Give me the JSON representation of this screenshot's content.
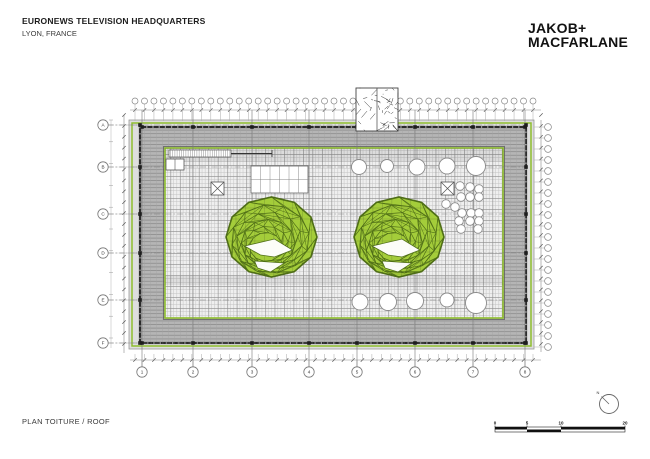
{
  "header": {
    "project_title": "EURONEWS TELEVISION HEADQUARTERS",
    "project_location": "LYON, FRANCE",
    "firm_line1": "JAKOB+",
    "firm_line2": "MACFARLANE"
  },
  "footer": {
    "drawing_title": "PLAN TOITURE / ROOF"
  },
  "scale_bar": {
    "labels": [
      "0",
      "5",
      "10",
      "20"
    ]
  },
  "north_arrow": {
    "label": "N"
  },
  "colors": {
    "crater_green": "#a4cd3a",
    "crater_line": "#4f6e17",
    "edge_green": "#8fbe2e",
    "band_gray": "#b5b5b5",
    "band_stripe": "#8c8c8c",
    "frame_dark": "#2b2b2b"
  },
  "plan": {
    "column_labels": [
      "1",
      "2",
      "3",
      "4",
      "5",
      "6",
      "7",
      "8"
    ],
    "row_labels": [
      "A",
      "B",
      "C",
      "D",
      "E",
      "F"
    ],
    "column_x": [
      142,
      193,
      252,
      309,
      357,
      415,
      473,
      525
    ],
    "row_y": [
      125,
      167,
      214,
      253,
      300,
      343
    ],
    "outer_rect": {
      "x": 129,
      "y": 120,
      "w": 405,
      "h": 229
    },
    "green_edge_rect": {
      "x": 132,
      "y": 123,
      "w": 399,
      "h": 223
    },
    "frame_rect": {
      "x": 140,
      "y": 127,
      "w": 386,
      "h": 216
    },
    "inner_rect": {
      "x": 165,
      "y": 148,
      "w": 338,
      "h": 170
    },
    "facade_bubbles_top": {
      "count": 43,
      "x0": 135,
      "x1": 533,
      "y": 101,
      "r": 3
    },
    "facade_bubbles_right": {
      "count": 21,
      "x": 548,
      "y0": 127,
      "step": 11,
      "r": 3.4
    },
    "left_bubbles": {
      "x": 103,
      "r": 5.2
    },
    "bottom_bubbles": {
      "y": 372,
      "r": 5.2
    },
    "dim_lines": {
      "top_y": 110,
      "bottom_y": 360,
      "left_x": 124,
      "left_x2": 111,
      "right_x": 541
    },
    "craters": [
      {
        "cx": 271.5,
        "cy": 237,
        "rx": 45.5,
        "ry": 40
      },
      {
        "cx": 399,
        "cy": 237,
        "rx": 45,
        "ry": 40
      }
    ],
    "skylights_top": [
      {
        "x": 359,
        "y": 167,
        "r": 7.5
      },
      {
        "x": 387,
        "y": 166,
        "r": 6.5
      },
      {
        "x": 417,
        "y": 167,
        "r": 8
      },
      {
        "x": 447,
        "y": 166,
        "r": 8
      },
      {
        "x": 476,
        "y": 166,
        "r": 9.5
      }
    ],
    "skylights_bottom": [
      {
        "x": 360,
        "y": 302,
        "r": 8
      },
      {
        "x": 388,
        "y": 302,
        "r": 8.5
      },
      {
        "x": 415,
        "y": 301,
        "r": 8.5
      },
      {
        "x": 447,
        "y": 300,
        "r": 7
      },
      {
        "x": 476,
        "y": 303,
        "r": 10.5
      }
    ],
    "vent_cluster": [
      {
        "x": 460,
        "y": 186
      },
      {
        "x": 470,
        "y": 187
      },
      {
        "x": 479,
        "y": 189
      },
      {
        "x": 461,
        "y": 197
      },
      {
        "x": 470,
        "y": 197
      },
      {
        "x": 479,
        "y": 197
      },
      {
        "x": 446,
        "y": 204
      },
      {
        "x": 455,
        "y": 207
      },
      {
        "x": 462,
        "y": 213
      },
      {
        "x": 471,
        "y": 213
      },
      {
        "x": 479,
        "y": 213
      },
      {
        "x": 459,
        "y": 221
      },
      {
        "x": 470,
        "y": 221
      },
      {
        "x": 479,
        "y": 221
      },
      {
        "x": 461,
        "y": 229
      },
      {
        "x": 478,
        "y": 229
      }
    ],
    "vent_radius": 4.3,
    "hatch_squares": [
      {
        "x": 211,
        "y": 182,
        "s": 13
      },
      {
        "x": 441,
        "y": 182,
        "s": 13
      }
    ],
    "skylight_grid": {
      "x": 251,
      "y": 166,
      "w": 57,
      "h": 27,
      "cols": 6,
      "rows": 2
    },
    "hatch_strip": {
      "x": 169,
      "y": 150,
      "w": 62,
      "h": 7
    },
    "access_rect": {
      "x": 166,
      "y": 159,
      "w": 18,
      "h": 11
    },
    "equipment_block": {
      "x": 356,
      "y": 88,
      "w": 42,
      "h": 43
    },
    "scale_bar_geom": {
      "x": 495,
      "y": 427,
      "w": 130,
      "h": 5,
      "tick_x": [
        495,
        527,
        561,
        625
      ]
    },
    "north_geom": {
      "cx": 609,
      "cy": 404,
      "r": 9.5
    }
  }
}
